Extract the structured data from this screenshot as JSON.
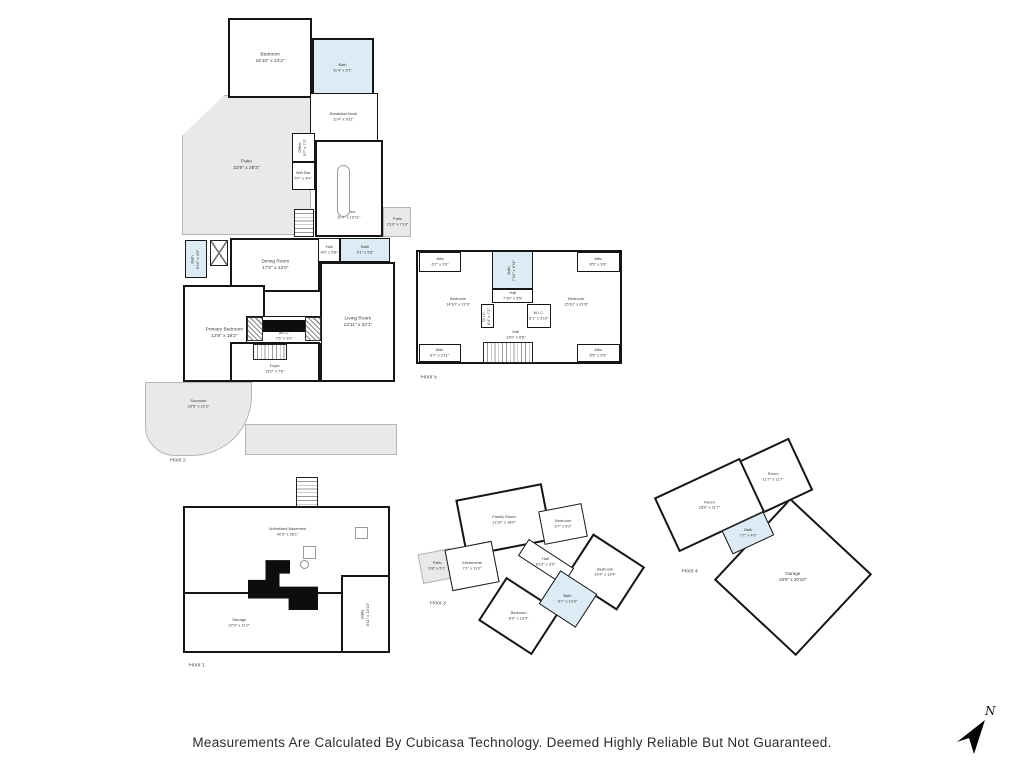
{
  "disclaimer": "Measurements Are Calculated By Cubicasa Technology. Deemed Highly Reliable But Not Guaranteed.",
  "compass": {
    "label": "N"
  },
  "colors": {
    "wall": "#151515",
    "bath_fill": "#dcebf4",
    "deck_fill": "#e9e9e9",
    "text": "#3a3a3a"
  },
  "floors": [
    {
      "label": "Floor 2",
      "rooms": [
        {
          "name": "Bedroom",
          "dims": "16'10\" x 13'2\""
        },
        {
          "name": "Bath",
          "dims": "11'4\" x 9'1\""
        },
        {
          "name": "Breakfast Nook",
          "dims": "11'4\" x 9'11\""
        },
        {
          "name": "Patio",
          "dims": "22'8\" x 29'3\""
        },
        {
          "name": "Office",
          "dims": "5'7\" x 7'2\""
        },
        {
          "name": "Wet Bar",
          "dims": "5'7\" x 4'0\""
        },
        {
          "name": "Kitchen",
          "dims": "11'4\" x 19'11\""
        },
        {
          "name": "Patio",
          "dims": "2'10\" x 7'10\""
        },
        {
          "name": "Bath",
          "dims": "8'10\" x 4'9\""
        },
        {
          "name": "Dining Room",
          "dims": "17'2\" x 12'0\""
        },
        {
          "name": "Hall",
          "dims": "4'6\" x 5'8\""
        },
        {
          "name": "Bath",
          "dims": "9'1\" x 5'8\""
        },
        {
          "name": "Living Room",
          "dims": "13'11\" x 22'1\""
        },
        {
          "name": "Primary Bedroom",
          "dims": "12'8\" x 19'2\""
        },
        {
          "name": "W.I.C.",
          "dims": "7'6\" x 3'2\""
        },
        {
          "name": "Foyer",
          "dims": "13'0\" x 7'6\""
        },
        {
          "name": "Sunroom",
          "dims": "23'9\" x 22'2\""
        }
      ]
    },
    {
      "label": "Floor 5",
      "rooms": [
        {
          "name": "Attic",
          "dims": "6'7\" x 3'9\""
        },
        {
          "name": "Bath",
          "dims": "7'10\" x 6'11\""
        },
        {
          "name": "Attic",
          "dims": "8'5\" x 3'9\""
        },
        {
          "name": "Hall",
          "dims": "7'10\" x 3'5\""
        },
        {
          "name": "Bedroom",
          "dims": "14'10\" x 21'9\""
        },
        {
          "name": "Bedroom",
          "dims": "15'10\" x 21'8\""
        },
        {
          "name": "W.I.C.",
          "dims": "6'4\" x 7'1\""
        },
        {
          "name": "W.I.C.",
          "dims": "6'1\" x 3'10\""
        },
        {
          "name": "Hall",
          "dims": "13'0\" x 6'8\""
        },
        {
          "name": "Attic",
          "dims": "6'7\" x 2'11\""
        },
        {
          "name": "Attic",
          "dims": "8'5\" x 2'9\""
        }
      ]
    },
    {
      "label": "Floor 1",
      "rooms": [
        {
          "name": "Unfinished Basement",
          "dims": "40'3\" x 28'1\""
        },
        {
          "name": "Storage",
          "dims": "22'9\" x 11'2\""
        },
        {
          "name": "Utility",
          "dims": "8'11\" x 13'10\""
        }
      ]
    },
    {
      "label": "Floor 3",
      "rooms": [
        {
          "name": "Family Room",
          "dims": "11'10\" x 18'0\""
        },
        {
          "name": "Bedroom",
          "dims": "6'7\" x 6'2\""
        },
        {
          "name": "Patio",
          "dims": "6'8\" x 5'1\""
        },
        {
          "name": "Kitchenette",
          "dims": "7'1\" x 11'0\""
        },
        {
          "name": "Hall",
          "dims": "8'10\" x 3'0\""
        },
        {
          "name": "Bedroom",
          "dims": "10'4\" x 13'4\""
        },
        {
          "name": "Bath",
          "dims": "6'7\" x 10'3\""
        },
        {
          "name": "Bedroom",
          "dims": "8'9\" x 13'3\""
        }
      ]
    },
    {
      "label": "Floor 4",
      "rooms": [
        {
          "name": "Room",
          "dims": "11'7\" x 11'7\""
        },
        {
          "name": "Room",
          "dims": "18'0\" x 11'7\""
        },
        {
          "name": "Bath",
          "dims": "7'7\" x 4'6\""
        },
        {
          "name": "Garage",
          "dims": "20'8\" x 20'10\""
        }
      ]
    }
  ]
}
